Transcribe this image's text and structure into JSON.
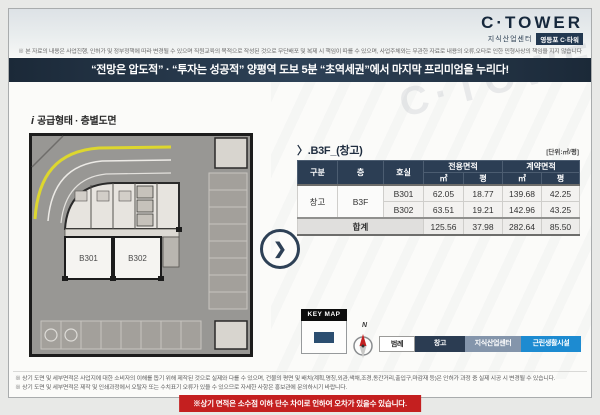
{
  "brand": {
    "logo_text": "C·TOWER",
    "logo_sub": "지식산업센터",
    "logo_badge": "영등포 C·타워",
    "watermark": "C·TOWER",
    "accent_navy": "#2c3e54",
    "accent_blue": "#1d8bd1",
    "warning_red": "#c41f1f"
  },
  "top": {
    "disclaimer": "※ 본 자료의 내용은 사업진행, 인허가 및 정부정책에 따라 변경될 수 있으며 직원교육의 목적으로 작성된 것으로 무단배포 및 복제 시 책임이 따를 수 있으며, 사업주체와는 무관한 자료로 내용의 오류,오타로 인한 민형사상의 책임을 지지 않습니다",
    "banner": "“전망은 압도적” · “투자는 성공적” 양평역 도보 5분 “초역세권”에서 마지막 프리미엄을 누리다!"
  },
  "plan": {
    "info_icon": "i",
    "section_label": "공급형태 · 층별도면",
    "room1": "B301",
    "room2": "B302",
    "chevron": "❯"
  },
  "table": {
    "title": "〉.B3F_(창고)",
    "unit_label": "[단위:㎡/평]",
    "col_gubun": "구분",
    "col_floor": "층",
    "col_room": "호실",
    "col_exclusive": "전용면적",
    "col_contract": "계약면적",
    "col_m2": "㎡",
    "col_py": "평",
    "rows": [
      {
        "gubun": "창고",
        "floor": "B3F",
        "room": "B301",
        "ex_m2": "62.05",
        "ex_py": "18.77",
        "ct_m2": "139.68",
        "ct_py": "42.25"
      },
      {
        "room": "B302",
        "ex_m2": "63.51",
        "ex_py": "19.21",
        "ct_m2": "142.96",
        "ct_py": "43.25"
      }
    ],
    "total_label": "합계",
    "total": {
      "ex_m2": "125.56",
      "ex_py": "37.98",
      "ct_m2": "282.64",
      "ct_py": "85.50"
    }
  },
  "keymap": {
    "title": "KEY MAP",
    "compass_label": "N"
  },
  "legend": {
    "items": [
      {
        "label": "범례",
        "bg": "#ffffff",
        "fg": "#222222"
      },
      {
        "label": "창고",
        "bg": "#2b3c52",
        "fg": "#ffffff"
      },
      {
        "label": "지식산업센터",
        "bg": "#8495ab",
        "fg": "#ffffff"
      },
      {
        "label": "근린생활시설",
        "bg": "#1d8bd1",
        "fg": "#ffffff"
      }
    ]
  },
  "footer": {
    "note1": "※ 상기 도면 및 세부면적은 사업지에 대한 소비자의 이해를 돕기 위해 제작된 것으로 실제와 다를 수 있으며, 건물의 평면 및 배치(계획,명칭,외관,색채,조경,동간거리,출입구,마감재 등)은 인허가 과정 중 실제 시공 시 변경될 수 있습니다.",
    "note2": "※ 상기 도면 및 세부면적은 제작 및 인쇄과정에서 오탈자 또는 수치표기 오류가 있을 수 있으므로 자세한 사항은 홍보관에 문의하시기 바랍니다.",
    "warning": "※상기 면적은 소수점 이하 단수 차이로 인하여 오차가 있을수 있습니다."
  }
}
